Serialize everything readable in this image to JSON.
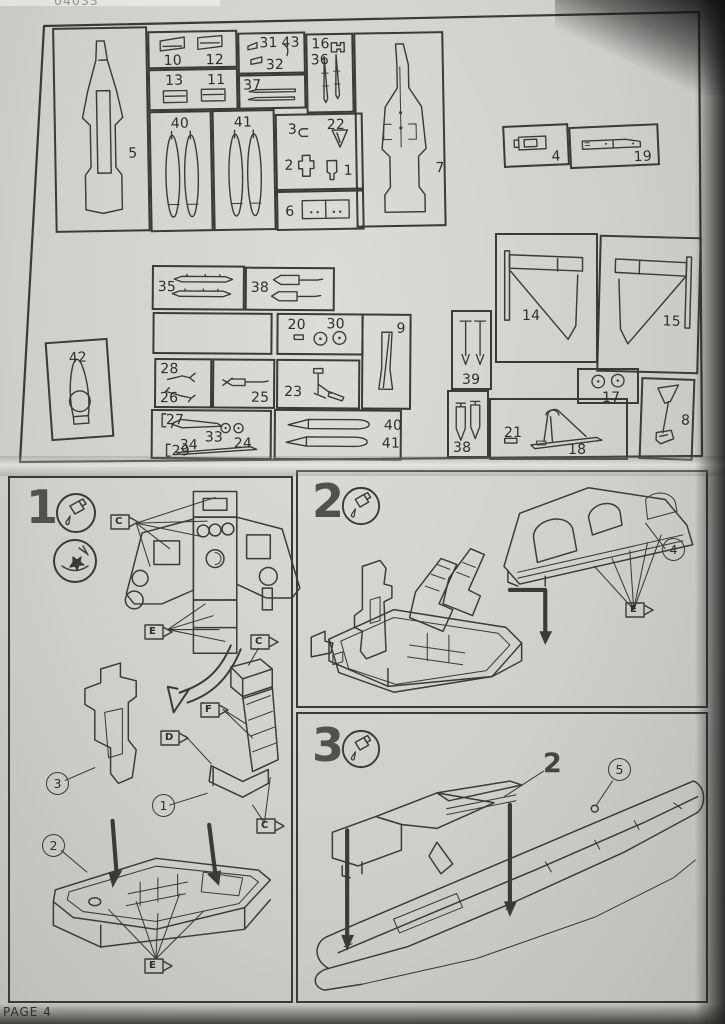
{
  "page": {
    "kit_number": "04033",
    "page_label": "PAGE 4"
  },
  "colors": {
    "paper": "#cfcecb",
    "ink": "#3b3a35",
    "numeral": "#53514b"
  },
  "icons": {
    "glue": "glue-tube-icon",
    "trim": "sprue-knife-icon"
  },
  "sprues": {
    "p5": "5",
    "p10": "10",
    "p12": "12",
    "p13": "13",
    "p11": "11",
    "p31": "31",
    "p43": "43",
    "p32": "32",
    "p37": "37",
    "p16": "16",
    "p36": "36",
    "p40v": "40",
    "p41v": "41",
    "p3": "3",
    "p22": "22",
    "p2": "2",
    "p1": "1",
    "p6": "6",
    "p7": "7",
    "p4": "4",
    "p19": "19",
    "p35": "35",
    "p38m": "38",
    "p20": "20",
    "p30": "30",
    "p9": "9",
    "p28": "28",
    "p26": "26",
    "p25": "25",
    "p23": "23",
    "p27": "27",
    "p34": "34",
    "p33": "33",
    "p24": "24",
    "p29": "29",
    "p40h": "40",
    "p41h": "41",
    "p42": "42",
    "p14": "14",
    "p15": "15",
    "p39": "39",
    "p38r": "38",
    "p21": "21",
    "p18": "18",
    "p17": "17",
    "p8": "8"
  },
  "steps": {
    "s1": {
      "number": "1",
      "flag_c_top": "C",
      "flag_e_mid": "E",
      "flag_c_seat_top": "C",
      "flag_f": "F",
      "flag_d": "D",
      "flag_c_seat_bottom": "C",
      "flag_e_tub": "E",
      "callout_bulkhead": "3",
      "callout_seat": "1",
      "callout_tub": "2"
    },
    "s2": {
      "number": "2",
      "callout_deck": "4",
      "flag_e": "E"
    },
    "s3": {
      "number": "3",
      "assembly_label": "2",
      "callout_fuselage": "5"
    }
  }
}
